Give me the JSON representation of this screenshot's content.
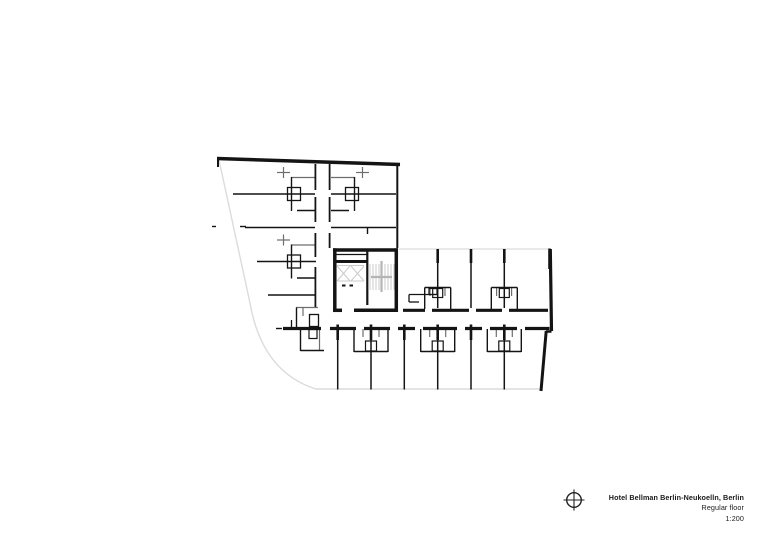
{
  "colors": {
    "ink": "#141414",
    "mid": "#6e6e6e",
    "light": "#dcdcdc",
    "stair": "#cbcbcb",
    "cross": "#b4b4b4",
    "text": "#1a1a1a"
  },
  "title_block": {
    "project": "Hotel Bellman Berlin-Neukoelln, Berlin",
    "floor": "Regular floor",
    "scale": "1:200"
  },
  "plan": {
    "canvas": {
      "width": 780,
      "height": 552
    },
    "paths": [
      {
        "d": "M 219,160 L 250,303 Q 262,372 316,389 L 540,389",
        "w": 1.4,
        "c": "light"
      },
      {
        "d": "M 399,249 L 548,249",
        "w": 1.3,
        "c": "light"
      }
    ],
    "lines": [
      [
        370,
        264,
        370,
        290,
        1,
        "stair"
      ],
      [
        373,
        264,
        373,
        290,
        1,
        "stair"
      ],
      [
        376,
        264,
        376,
        290,
        1,
        "stair"
      ],
      [
        379,
        264,
        379,
        290,
        1,
        "stair"
      ],
      [
        382,
        264,
        382,
        290,
        1,
        "stair"
      ],
      [
        385,
        264,
        385,
        290,
        1,
        "stair"
      ],
      [
        388,
        264,
        388,
        290,
        1,
        "stair"
      ],
      [
        391,
        264,
        391,
        290,
        1,
        "stair"
      ],
      [
        394,
        264,
        394,
        290,
        1,
        "stair"
      ],
      [
        381.5,
        261,
        381.5,
        292,
        2.2,
        "cross"
      ],
      [
        371,
        277,
        392,
        277,
        2.2,
        "cross"
      ],
      [
        337,
        265.5,
        364,
        265.5,
        1,
        "stair"
      ],
      [
        337,
        281,
        364,
        281,
        1,
        "stair"
      ],
      [
        337,
        266,
        350,
        281,
        1,
        "stair"
      ],
      [
        350,
        266,
        337,
        281,
        1,
        "stair"
      ],
      [
        351,
        266,
        364,
        281,
        1,
        "stair"
      ],
      [
        364,
        266,
        351,
        281,
        1,
        "stair"
      ],
      [
        291,
        177.5,
        315,
        177.5,
        1.2,
        "mid"
      ],
      [
        283.5,
        167,
        283.5,
        178,
        1.2,
        "mid"
      ],
      [
        277,
        172.5,
        290,
        172.5,
        1.2,
        "mid"
      ],
      [
        331,
        177.5,
        355,
        177.5,
        1.2,
        "mid"
      ],
      [
        362.5,
        167,
        362.5,
        178,
        1.2,
        "mid"
      ],
      [
        356,
        172.5,
        369,
        172.5,
        1.2,
        "mid"
      ],
      [
        291,
        245,
        315,
        245,
        1.2,
        "mid"
      ],
      [
        283.5,
        234.5,
        283.5,
        245.5,
        1.2,
        "mid"
      ],
      [
        277,
        240,
        290,
        240,
        1.2,
        "mid"
      ],
      [
        430,
        288,
        430,
        296,
        1.2,
        "mid"
      ],
      [
        445,
        288,
        445,
        296,
        1.2,
        "mid"
      ],
      [
        496.6,
        288,
        496.6,
        296,
        1.2,
        "mid"
      ],
      [
        511.6,
        288,
        511.6,
        296,
        1.2,
        "mid"
      ],
      [
        363,
        329,
        363,
        337,
        1.2,
        "mid"
      ],
      [
        379,
        329,
        379,
        337,
        1.2,
        "mid"
      ],
      [
        429.7,
        329,
        429.7,
        337,
        1.2,
        "mid"
      ],
      [
        445.7,
        329,
        445.7,
        337,
        1.2,
        "mid"
      ],
      [
        496.3,
        329,
        496.3,
        337,
        1.2,
        "mid"
      ],
      [
        512.3,
        329,
        512.3,
        337,
        1.2,
        "mid"
      ],
      [
        296,
        307.5,
        318,
        307.5,
        1.2,
        "mid"
      ],
      [
        303,
        308,
        303,
        316,
        1.2,
        "mid"
      ],
      [
        319.5,
        329,
        319.5,
        350,
        1.2,
        "mid"
      ],
      [
        233,
        194,
        315,
        194,
        1.6,
        "ink"
      ],
      [
        331,
        194,
        396,
        194,
        1.6,
        "ink"
      ],
      [
        245,
        227.5,
        315,
        227.5,
        1.6,
        "ink"
      ],
      [
        331,
        227.5,
        396,
        227.5,
        1.6,
        "ink"
      ],
      [
        367.5,
        227.5,
        367.5,
        234,
        1.4,
        "ink"
      ],
      [
        257,
        261.5,
        316,
        261.5,
        1.6,
        "ink"
      ],
      [
        268,
        295,
        315,
        295,
        1.6,
        "ink"
      ],
      [
        315.4,
        164,
        315.4,
        190,
        1.8,
        "ink"
      ],
      [
        315.4,
        197,
        315.4,
        222,
        1.8,
        "ink"
      ],
      [
        315.4,
        233,
        315.4,
        257,
        1.8,
        "ink"
      ],
      [
        315.4,
        267,
        315.4,
        307,
        1.8,
        "ink"
      ],
      [
        329.6,
        164,
        329.6,
        190,
        1.8,
        "ink"
      ],
      [
        329.6,
        197,
        329.6,
        222,
        1.8,
        "ink"
      ],
      [
        329.6,
        233,
        329.6,
        248,
        1.8,
        "ink"
      ],
      [
        437.7,
        250,
        437.7,
        308,
        1.5,
        "ink"
      ],
      [
        471,
        250,
        471,
        308,
        1.5,
        "ink"
      ],
      [
        504.3,
        250,
        504.3,
        308,
        1.5,
        "ink"
      ],
      [
        337.7,
        340,
        337.7,
        389.5,
        1.5,
        "ink"
      ],
      [
        371,
        340,
        371,
        389.5,
        1.5,
        "ink"
      ],
      [
        404.3,
        340,
        404.3,
        389.5,
        1.5,
        "ink"
      ],
      [
        437.7,
        340,
        437.7,
        389.5,
        1.5,
        "ink"
      ],
      [
        471,
        340,
        471,
        389.5,
        1.5,
        "ink"
      ],
      [
        504.3,
        340,
        504.3,
        389.5,
        1.5,
        "ink"
      ],
      [
        335,
        254.5,
        367,
        254.5,
        1.2,
        "ink"
      ],
      [
        240,
        226.5,
        246,
        226.5,
        1.4,
        "ink"
      ],
      [
        212,
        226.5,
        216,
        226.5,
        1.4,
        "ink"
      ],
      [
        342,
        285.5,
        345.5,
        285.5,
        2,
        "ink"
      ],
      [
        349.5,
        285.5,
        353,
        285.5,
        2,
        "ink"
      ],
      [
        291.5,
        320,
        291.5,
        328,
        1.3,
        "ink"
      ],
      [
        276,
        328.5,
        282,
        328.5,
        1.4,
        "ink"
      ],
      [
        409,
        294.5,
        437,
        294.5,
        1.3,
        "ink"
      ],
      [
        409,
        294.5,
        409,
        302,
        1.3,
        "ink"
      ],
      [
        409,
        302,
        419,
        302,
        1.3,
        "ink"
      ],
      [
        291.5,
        177,
        291.5,
        211,
        1.4,
        "ink"
      ],
      [
        297,
        210.5,
        315,
        210.5,
        1.4,
        "ink"
      ],
      [
        354.5,
        177,
        354.5,
        211,
        1.4,
        "ink"
      ],
      [
        331,
        210.5,
        349,
        210.5,
        1.4,
        "ink"
      ],
      [
        291.5,
        244.5,
        291.5,
        278.5,
        1.4,
        "ink"
      ],
      [
        297,
        278,
        315,
        278,
        1.4,
        "ink"
      ],
      [
        424.7,
        287.5,
        450.7,
        287.5,
        1.4,
        "ink"
      ],
      [
        424.7,
        287.5,
        424.7,
        309,
        1.4,
        "ink"
      ],
      [
        450.7,
        287.5,
        450.7,
        309,
        1.4,
        "ink"
      ],
      [
        491.3,
        287.5,
        517.3,
        287.5,
        1.4,
        "ink"
      ],
      [
        491.3,
        287.5,
        491.3,
        309,
        1.4,
        "ink"
      ],
      [
        517.3,
        287.5,
        517.3,
        309,
        1.4,
        "ink"
      ],
      [
        354,
        329,
        354,
        352,
        1.4,
        "ink"
      ],
      [
        388,
        329,
        388,
        352,
        1.4,
        "ink"
      ],
      [
        354,
        351.5,
        388,
        351.5,
        1.4,
        "ink"
      ],
      [
        420.7,
        329,
        420.7,
        352,
        1.4,
        "ink"
      ],
      [
        454.7,
        329,
        454.7,
        352,
        1.4,
        "ink"
      ],
      [
        420.7,
        351.5,
        454.7,
        351.5,
        1.4,
        "ink"
      ],
      [
        487.3,
        329,
        487.3,
        352,
        1.4,
        "ink"
      ],
      [
        521.3,
        329,
        521.3,
        352,
        1.4,
        "ink"
      ],
      [
        487.3,
        351.5,
        521.3,
        351.5,
        1.4,
        "ink"
      ],
      [
        296.5,
        307.5,
        296.5,
        327,
        1.4,
        "ink"
      ],
      [
        300.5,
        329,
        300.5,
        351,
        1.4,
        "ink"
      ],
      [
        300.5,
        350.5,
        324,
        350.5,
        1.4,
        "ink"
      ],
      [
        217,
        158.5,
        400,
        164.5,
        3.5,
        "ink"
      ],
      [
        218,
        157,
        218,
        167,
        2,
        "ink"
      ],
      [
        333,
        250,
        398,
        250,
        3.5,
        "ink"
      ],
      [
        334.8,
        248.3,
        334.8,
        309,
        3.5,
        "ink"
      ],
      [
        396.3,
        248.3,
        396.3,
        312,
        3.5,
        "ink"
      ],
      [
        354,
        310.3,
        398,
        310.3,
        3.5,
        "ink"
      ],
      [
        333,
        310.3,
        342,
        310.3,
        3.5,
        "ink"
      ],
      [
        335,
        261.5,
        367,
        261.5,
        3,
        "ink"
      ],
      [
        367.3,
        250,
        367.3,
        305,
        2.2,
        "ink"
      ],
      [
        397.3,
        163,
        397.3,
        248,
        2,
        "ink"
      ],
      [
        550.3,
        249,
        551.5,
        331,
        3.2,
        "ink"
      ],
      [
        546,
        331.5,
        551.5,
        331.5,
        2.5,
        "ink"
      ],
      [
        546.2,
        331,
        541,
        391,
        3,
        "ink"
      ],
      [
        403,
        310.3,
        425,
        310.3,
        3.2,
        "ink"
      ],
      [
        432,
        310.3,
        469,
        310.3,
        3.2,
        "ink"
      ],
      [
        476,
        310.3,
        502,
        310.3,
        3.2,
        "ink"
      ],
      [
        509,
        310.3,
        548,
        310.3,
        3.2,
        "ink"
      ],
      [
        283,
        328.5,
        321,
        328.5,
        3.2,
        "ink"
      ],
      [
        330,
        328.5,
        356,
        328.5,
        3.2,
        "ink"
      ],
      [
        364,
        328.5,
        390,
        328.5,
        3.2,
        "ink"
      ],
      [
        398,
        328.5,
        415,
        328.5,
        3.2,
        "ink"
      ],
      [
        423,
        328.5,
        457,
        328.5,
        3.2,
        "ink"
      ],
      [
        465,
        328.5,
        482,
        328.5,
        3.2,
        "ink"
      ],
      [
        490,
        328.5,
        517,
        328.5,
        3.2,
        "ink"
      ],
      [
        525,
        328.5,
        549.5,
        328.5,
        3.2,
        "ink"
      ],
      [
        337.7,
        324.5,
        337.7,
        340,
        2.6,
        "ink"
      ],
      [
        371,
        324.5,
        371,
        340,
        2.6,
        "ink"
      ],
      [
        404.3,
        324.5,
        404.3,
        340,
        2.6,
        "ink"
      ],
      [
        437.7,
        324.5,
        437.7,
        340,
        2.6,
        "ink"
      ],
      [
        471,
        324.5,
        471,
        340,
        2.6,
        "ink"
      ],
      [
        504.3,
        324.5,
        504.3,
        340,
        2.6,
        "ink"
      ],
      [
        437.7,
        249,
        437.7,
        263,
        2.6,
        "ink"
      ],
      [
        471,
        249,
        471,
        263,
        2.6,
        "ink"
      ],
      [
        504.3,
        249,
        504.3,
        263,
        2.6,
        "ink"
      ],
      [
        549.5,
        248.5,
        549.5,
        269,
        2.6,
        "ink"
      ]
    ],
    "rects": [
      [
        287.5,
        187.5,
        13,
        13,
        1.3,
        "ink"
      ],
      [
        345.5,
        187.5,
        13,
        13,
        1.3,
        "ink"
      ],
      [
        287.5,
        255,
        13,
        13,
        1.3,
        "ink"
      ],
      [
        432.7,
        288.5,
        10,
        9,
        1.2,
        "ink"
      ],
      [
        499.3,
        288.5,
        10,
        9,
        1.2,
        "ink"
      ],
      [
        365.5,
        341,
        11,
        10,
        1.2,
        "ink"
      ],
      [
        432.2,
        341,
        11,
        10,
        1.2,
        "ink"
      ],
      [
        498.8,
        341,
        11,
        10,
        1.2,
        "ink"
      ],
      [
        429,
        288.5,
        8,
        6,
        1.2,
        "ink"
      ],
      [
        309.5,
        314.5,
        9,
        12,
        1.3,
        "ink"
      ],
      [
        309,
        329.5,
        8,
        9,
        1.2,
        "ink"
      ]
    ]
  }
}
